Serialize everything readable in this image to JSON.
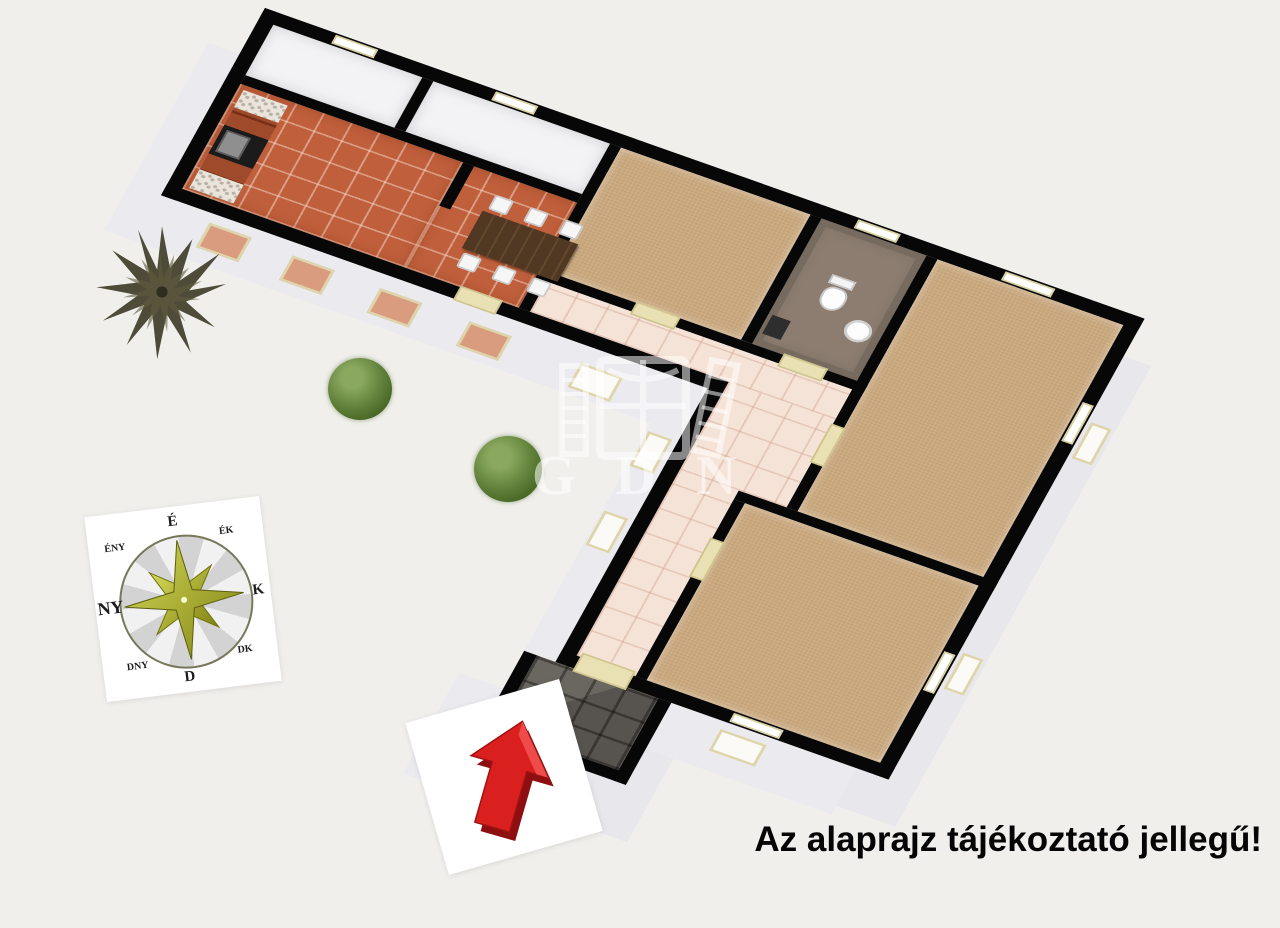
{
  "disclaimer": "Az alaprajz tájékoztató jellegű!",
  "watermark": {
    "text": "GDN"
  },
  "compass": {
    "n": "É",
    "ne": "ÉK",
    "e": "K",
    "se": "DK",
    "s": "D",
    "sw": "DNY",
    "w": "NY",
    "nw": "ÉNY"
  },
  "colors": {
    "background": "#f0efeb",
    "wall": "#070707",
    "wall_face": "#ebebef",
    "floor_white": "#f3f3f5",
    "floor_terracotta": "#bf5f3c",
    "floor_carpet": "#c9a87e",
    "floor_hall_tile": "#f6e3d8",
    "floor_entry_tile": "#57534e",
    "bathroom_floor": "#8d7d71",
    "kitchen_cabinet": "#a04a2c",
    "dining_table": "#503823",
    "door": "#e9e1b4",
    "window_frame": "#ded5ac",
    "arrow_red": "#da1f1f",
    "arrow_red_dark": "#8d0f12",
    "compass_star_light": "#d6da5a",
    "compass_star_dark": "#7d8110",
    "pine_tree": "#45422f",
    "bush": "#5d7e38"
  }
}
